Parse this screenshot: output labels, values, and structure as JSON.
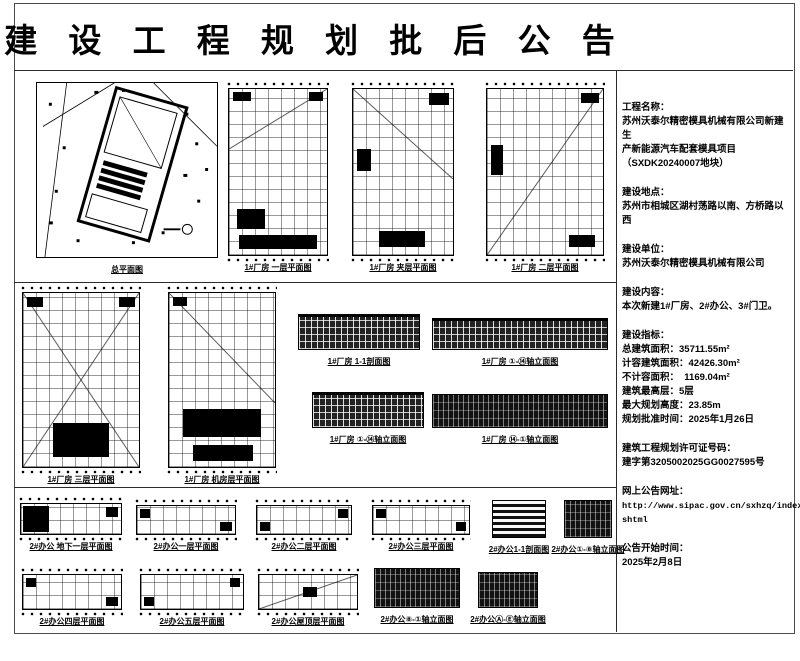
{
  "title": "建 设 工 程 规 划 批 后 公 告",
  "colors": {
    "ink": "#000000",
    "paper": "#ffffff",
    "frame_line": "#4a4a4a"
  },
  "info": {
    "sections": [
      {
        "heading": "工程名称：",
        "lines": [
          "苏州沃泰尔精密模具机械有限公司新建生",
          "产新能源汽车配套模具项目",
          "（SXDK20240007地块）"
        ]
      },
      {
        "heading": "建设地点：",
        "lines": [
          "苏州市相城区湖村荡路以南、方桥路以西"
        ]
      },
      {
        "heading": "建设单位：",
        "lines": [
          "苏州沃泰尔精密模具机械有限公司"
        ]
      },
      {
        "heading": "建设内容：",
        "lines": [
          "本次新建1#厂房、2#办公、3#门卫。"
        ]
      },
      {
        "heading": "建设指标：",
        "lines": [
          "总建筑面积：35711.55m²",
          "计容建筑面积：42426.30m²",
          "不计容面积：  1169.04m²",
          "建筑最高层：5层",
          "最大规划高度：23.85m",
          "规划批准时间：2025年1月26日"
        ]
      },
      {
        "heading": "建筑工程规划许可证号码：",
        "lines": [
          "建字第3205002025GG0027595号"
        ]
      },
      {
        "heading": "网上公告网址：",
        "lines": [
          "http://www.sipac.gov.cn/sxhzq/index.",
          "shtml"
        ]
      },
      {
        "heading": "公告开始时间：",
        "lines": [
          "2025年2月8日"
        ]
      }
    ]
  },
  "drawings": {
    "row1": [
      {
        "label": "总平面图"
      },
      {
        "label": "1#厂房 一层平面图"
      },
      {
        "label": "1#厂房 夹层平面图"
      },
      {
        "label": "1#厂房 二层平面图"
      }
    ],
    "row2": [
      {
        "label": "1#厂房 三层平面图"
      },
      {
        "label": "1#厂房 机房层平面图"
      },
      {
        "label": "1#厂房 1-1剖面图"
      },
      {
        "label": "1#厂房 ①-⑭轴立面图"
      },
      {
        "label": "1#厂房 ①-⑭轴立面图"
      },
      {
        "label": "1#厂房 ⑭-①轴立面图"
      }
    ],
    "row3": [
      {
        "label": "2#办公 地下一层平面图"
      },
      {
        "label": "2#办公一层平面图"
      },
      {
        "label": "2#办公二层平面图"
      },
      {
        "label": "2#办公三层平面图"
      },
      {
        "label": "2#办公1-1剖面图"
      },
      {
        "label": "2#办公①-⑧轴立面图"
      }
    ],
    "row4": [
      {
        "label": "2#办公四层平面图"
      },
      {
        "label": "2#办公五层平面图"
      },
      {
        "label": "2#办公屋顶层平面图"
      },
      {
        "label": "2#办公⑧-①轴立面图"
      },
      {
        "label": "2#办公Ⓐ-Ⓔ轴立面图"
      }
    ]
  }
}
